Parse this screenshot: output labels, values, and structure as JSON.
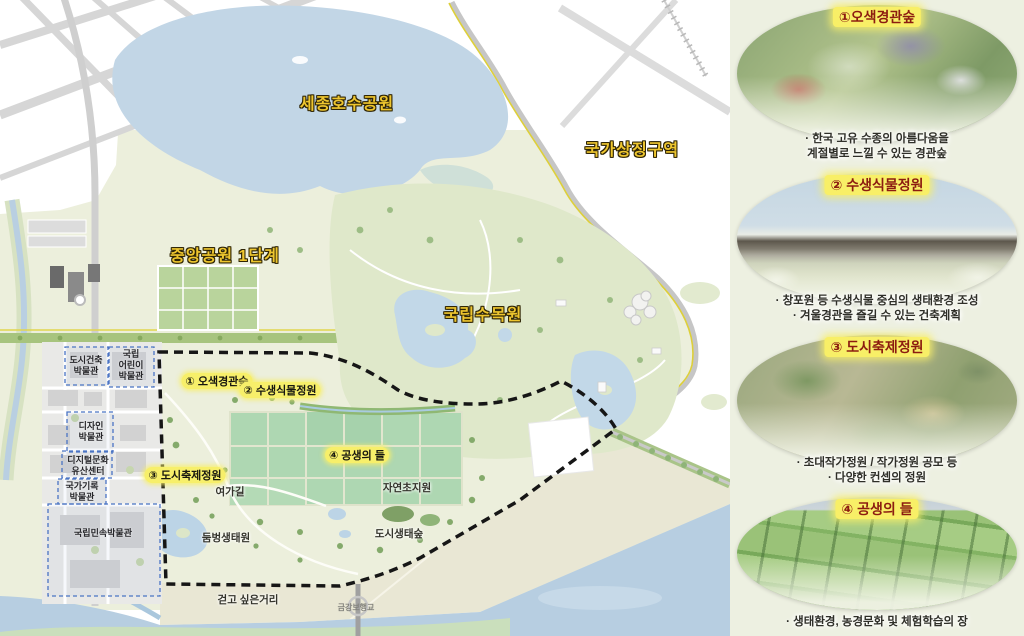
{
  "map": {
    "major_labels": [
      {
        "id": "sejong-lake-park",
        "text": "세종호수공원"
      },
      {
        "id": "national-symbolic-zone",
        "text": "국가상징구역"
      },
      {
        "id": "central-park-phase1",
        "text": "중앙공원 1단계"
      },
      {
        "id": "national-arboretum",
        "text": "국립수목원"
      }
    ],
    "zone_labels": [
      {
        "id": "osaek-scenic-forest",
        "text": "① 오색경관숲"
      },
      {
        "id": "aquatic-plant-garden",
        "text": "② 수생식물정원"
      },
      {
        "id": "urban-festival-garden",
        "text": "③ 도시축제정원"
      },
      {
        "id": "field-of-symbiosis",
        "text": "④ 공생의 들"
      }
    ],
    "place_labels": [
      {
        "id": "yeoga-trail",
        "text": "여가길"
      },
      {
        "id": "natural-grassland",
        "text": "자연초지원"
      },
      {
        "id": "dumbeong-eco-garden",
        "text": "둠벙생태원"
      },
      {
        "id": "urban-eco-forest",
        "text": "도시생태숲"
      },
      {
        "id": "walkable-street",
        "text": "걷고 싶은거리"
      },
      {
        "id": "geumgang-footbridge",
        "text": "금강보행교"
      }
    ],
    "museum_labels": [
      {
        "id": "urban-architecture-museum",
        "text": "도시건축\n박물관"
      },
      {
        "id": "national-childrens-museum",
        "text": "국립\n어린이\n박물관"
      },
      {
        "id": "design-museum",
        "text": "디자인\n박물관"
      },
      {
        "id": "digital-heritage-center",
        "text": "디지털문화\n유산센터"
      },
      {
        "id": "national-archives-museum",
        "text": "국가기록\n박물관"
      },
      {
        "id": "national-folk-museum",
        "text": "국립민속박물관"
      }
    ]
  },
  "sidebar": {
    "cards": [
      {
        "title": "①오색경관숲",
        "desc": "· 한국 고유 수종의 아름다움을\n계절별로 느낄 수 있는 경관숲"
      },
      {
        "title": "② 수생식물정원",
        "desc": "· 창포원 등 수생식물 중심의 생태환경 조성\n· 겨울경관을 즐길 수 있는 건축계획"
      },
      {
        "title": "③ 도시축제정원",
        "desc": "· 초대작가정원 / 작가정원 공모 등\n· 다양한 컨셉의 정원"
      },
      {
        "title": "④ 공생의 들",
        "desc": "· 생태환경, 농경문화 및 체험학습의 장"
      }
    ]
  },
  "colors": {
    "label_yellow": "#eec62f",
    "highlight_pill": "#f7ef6a",
    "card_title_red": "#8c1c10",
    "boundary_black": "#161616",
    "museum_dashed_blue": "#4a74c4",
    "panel_bg": "#edf0e1",
    "lake_blue": "#c2d6e6",
    "river_blue": "#b7cee1",
    "field_green": "#aed7b2"
  }
}
